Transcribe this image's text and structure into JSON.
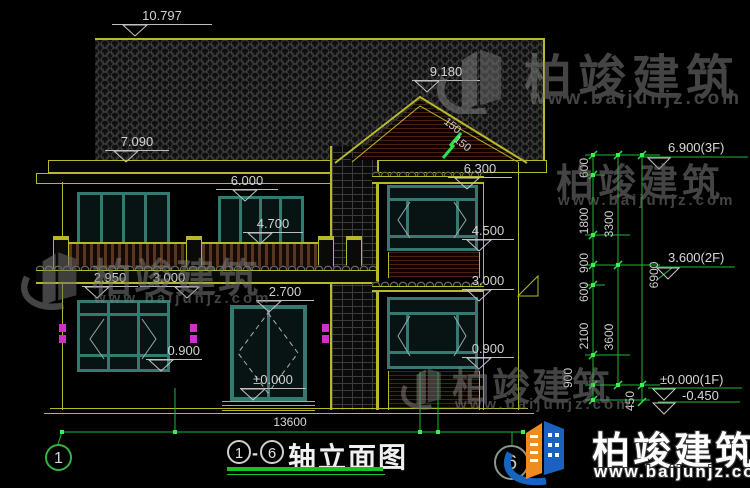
{
  "title": {
    "axis_from": "1",
    "separator": "-",
    "axis_to": "6",
    "name": "轴立面图"
  },
  "axes": {
    "left_bubble": "1",
    "right_bubble": "6"
  },
  "dims": {
    "overall_width": "13600",
    "ridge_main": "10.797",
    "eave_main": "7.090",
    "ridge_wing": "9.180",
    "eave_wing": "6.300",
    "level_6000": "6.000",
    "level_4700": "4.700",
    "level_4500": "4.500",
    "level_2950": "2.950",
    "level_3000_left": "3.000",
    "level_2700": "2.700",
    "level_3000_wing": "3.000",
    "level_0900_left": "0.900",
    "level_0900_wing": "0.900",
    "level_zero": "±0.000",
    "slope_1": "150",
    "slope_2": "150"
  },
  "side_dims": {
    "seg_600_a": "600",
    "seg_1800": "1800",
    "seg_900_a": "900",
    "seg_600_b": "600",
    "seg_2100": "2100",
    "seg_900_b": "900",
    "seg_450": "450",
    "seg_3300": "3300",
    "seg_3600": "3600",
    "seg_6900": "6900"
  },
  "levels": {
    "f3": "6.900(3F)",
    "f2": "3.600(2F)",
    "f1": "±0.000(1F)",
    "foundation": "-0.450"
  },
  "watermark": {
    "brand": "柏竣建筑",
    "url": "www.baijunjz.com"
  },
  "footer_logo": {
    "brand": "柏竣建筑",
    "url": "www.baijunjz.com"
  },
  "colors": {
    "line_yellow": "#b8b82a",
    "dim_green": "#1fb837",
    "frame_teal": "#357a70",
    "lamp_magenta": "#cf2fcf"
  }
}
